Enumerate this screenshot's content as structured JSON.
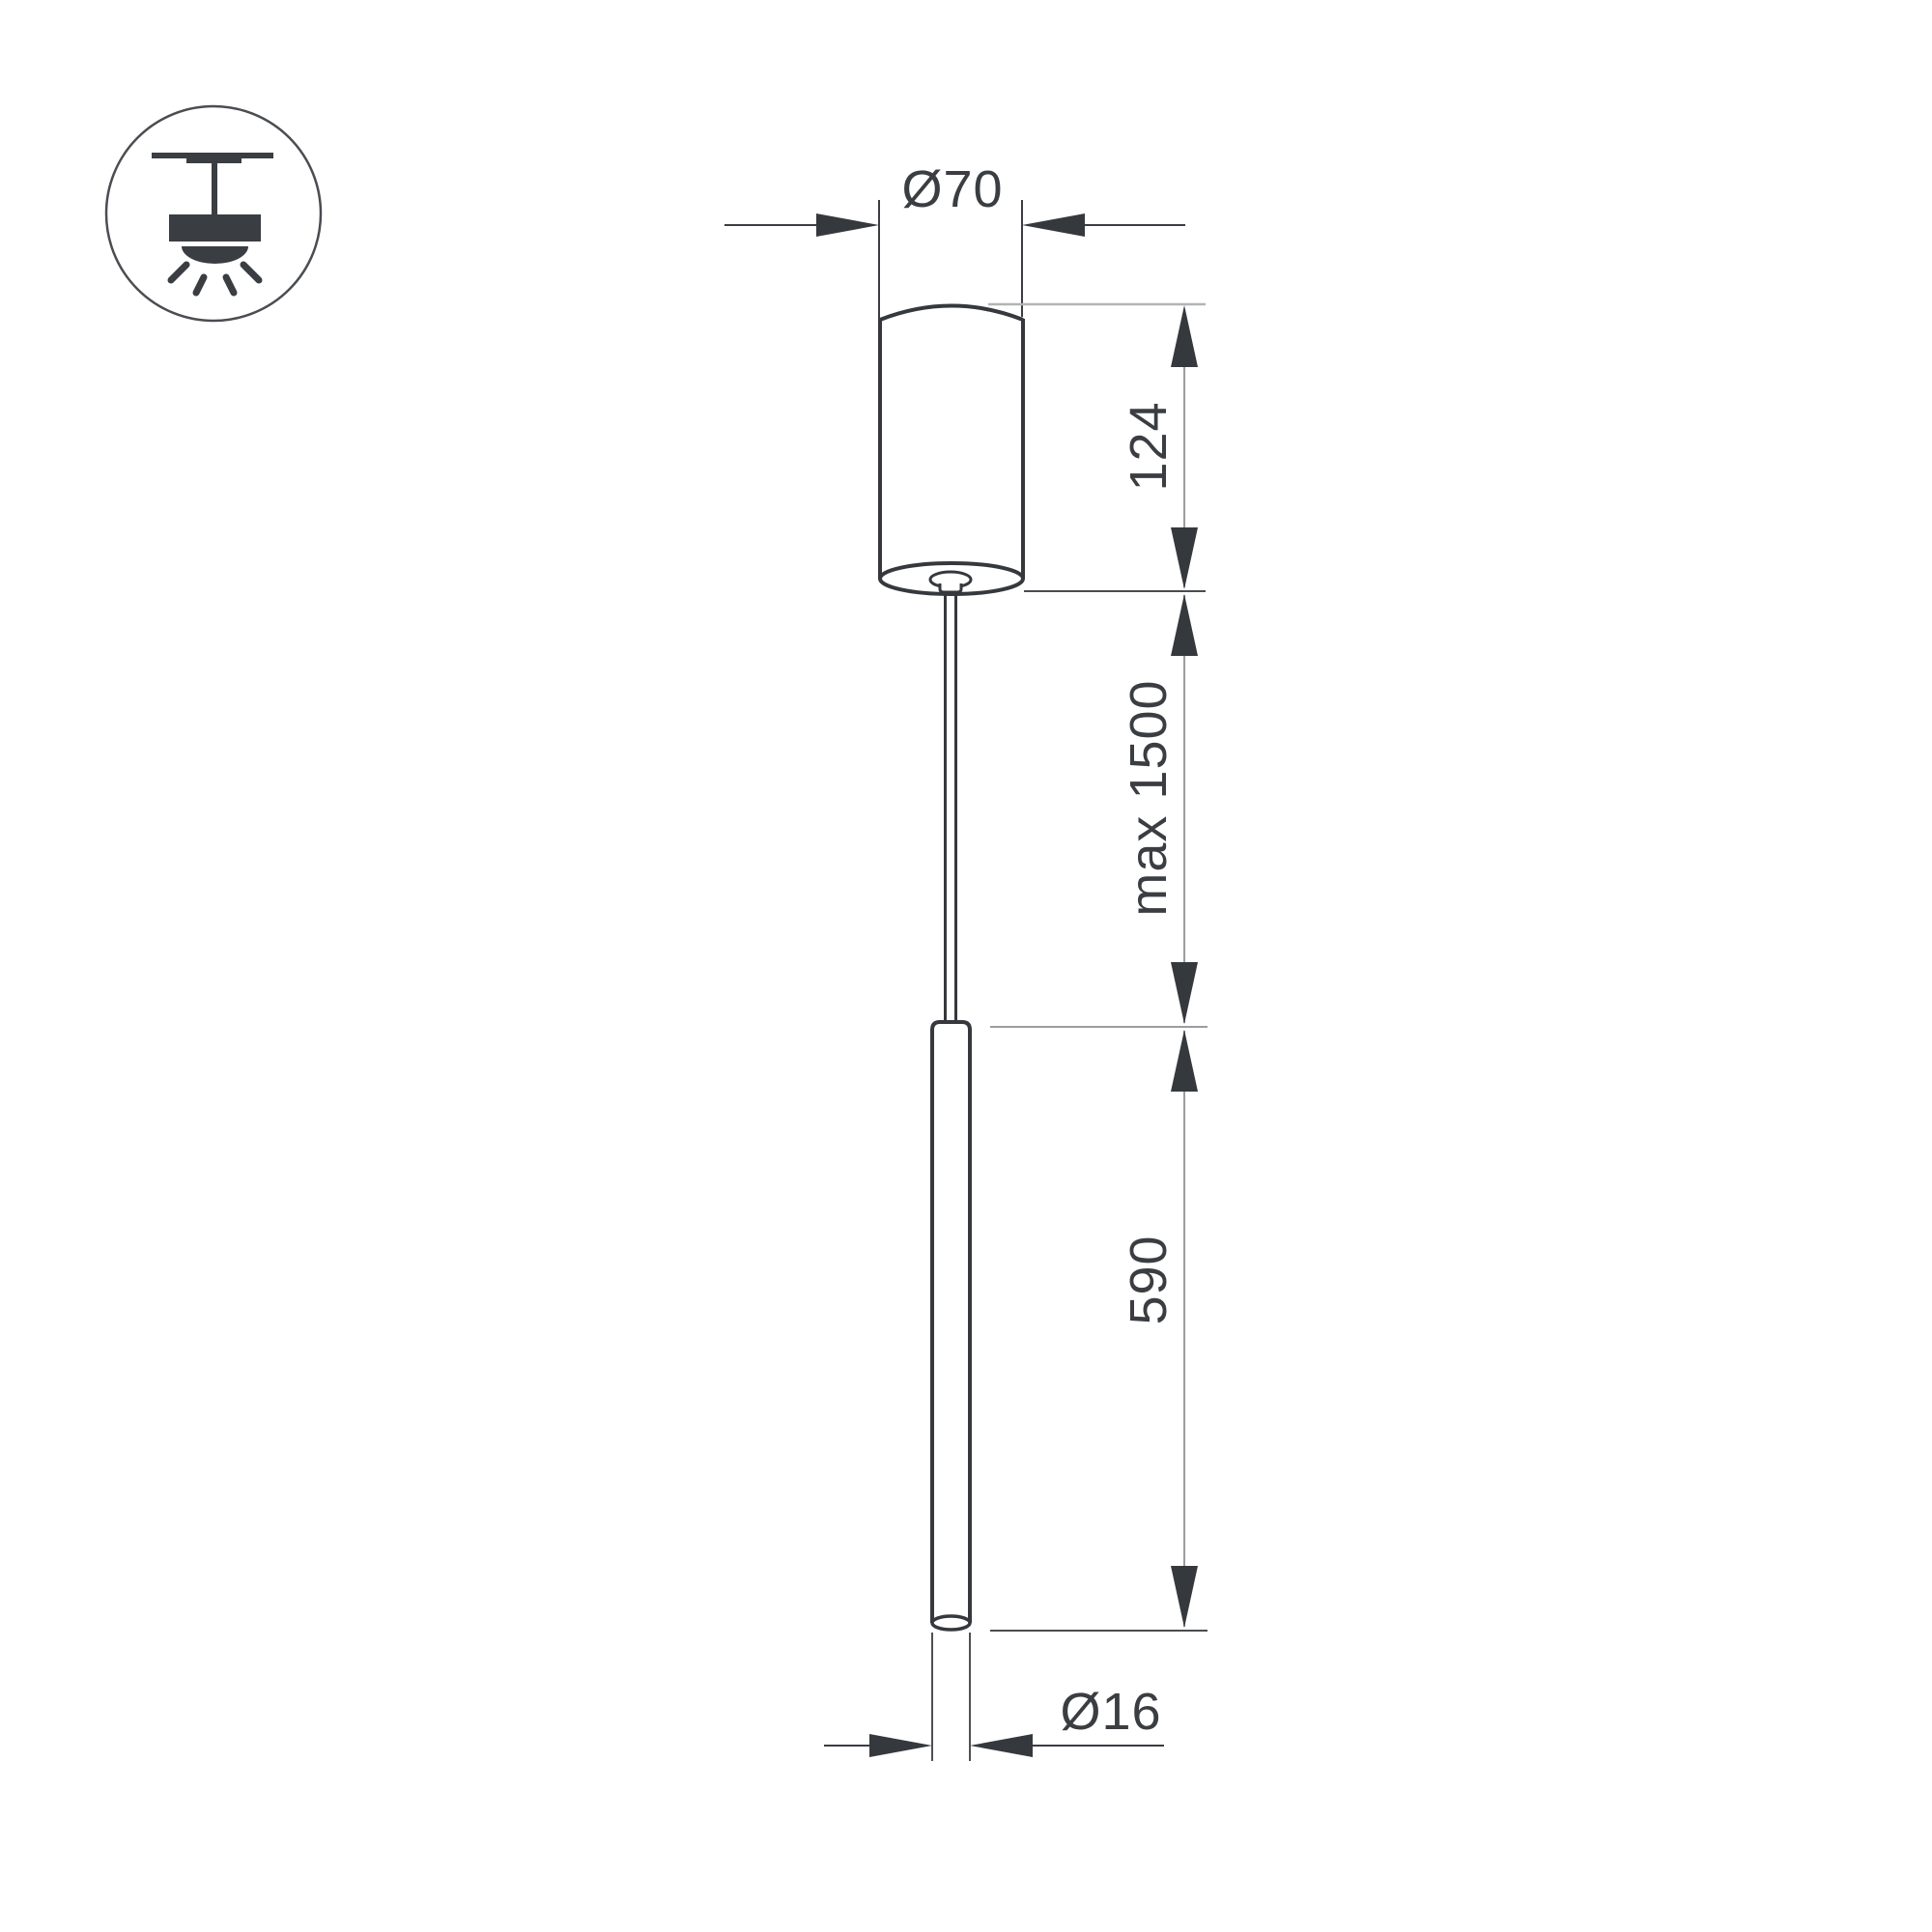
{
  "drawing": {
    "type": "technical-dimension-drawing",
    "subject": "pendant-lamp",
    "labels": {
      "canopy_diameter": "Ø70",
      "canopy_height": "124",
      "suspension_length": "max 1500",
      "tube_length": "590",
      "tube_diameter": "Ø16"
    },
    "icon": {
      "name": "pendant-ceiling-light-icon"
    },
    "colors": {
      "background": "#ffffff",
      "outline_dark": "#35383c",
      "dimension_gray": "#9b9da0",
      "extension_light_gray": "#b2b4b6",
      "text": "#3a3d41"
    }
  }
}
